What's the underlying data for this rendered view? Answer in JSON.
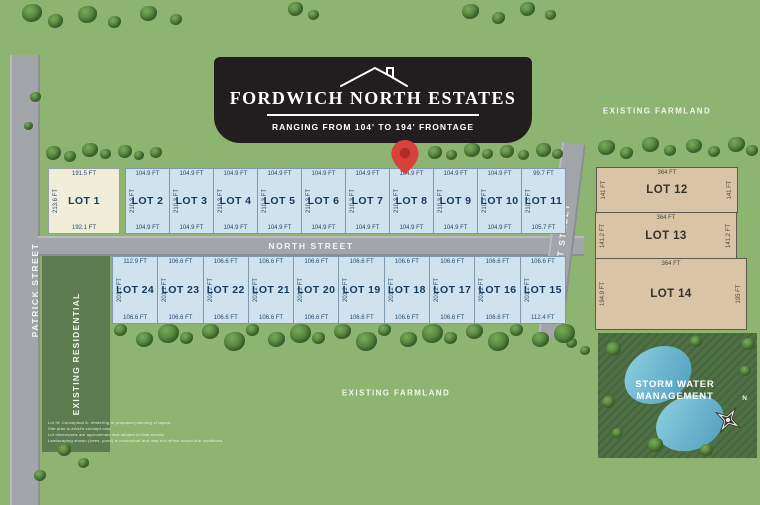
{
  "banner": {
    "title": "FORDWICH NORTH ESTATES",
    "subtitle": "RANGING FROM 104' TO 194' FRONTAGE"
  },
  "streets": {
    "patrick": "PATRICK STREET",
    "north": "NORTH STREET",
    "east": "EAST STREET"
  },
  "areas": {
    "farmland_top": "EXISTING FARMLAND",
    "farmland_bottom": "EXISTING FARMLAND",
    "residential": "EXISTING RESIDENTIAL",
    "storm_water_line1": "STORM WATER",
    "storm_water_line2": "MANAGEMENT"
  },
  "compass": {
    "north_label": "N"
  },
  "top_row": [
    {
      "name": "LOT 1",
      "top": "191.5 FT",
      "bottom": "192.1 FT",
      "side": "213.6 FT"
    },
    {
      "name": "LOT 2",
      "top": "104.9 FT",
      "bottom": "104.9 FT",
      "side": "210.3 FT"
    },
    {
      "name": "LOT 3",
      "top": "104.9 FT",
      "bottom": "104.9 FT",
      "side": "210.3 FT"
    },
    {
      "name": "LOT 4",
      "top": "104.9 FT",
      "bottom": "104.9 FT",
      "side": "210.3 FT"
    },
    {
      "name": "LOT 5",
      "top": "104.9 FT",
      "bottom": "104.9 FT",
      "side": "210.3 FT"
    },
    {
      "name": "LOT 6",
      "top": "104.9 FT",
      "bottom": "104.9 FT",
      "side": "210.3 FT"
    },
    {
      "name": "LOT 7",
      "top": "104.9 FT",
      "bottom": "104.9 FT",
      "side": "210.3 FT"
    },
    {
      "name": "LOT 8",
      "top": "104.9 FT",
      "bottom": "104.9 FT",
      "side": "210.3 FT"
    },
    {
      "name": "LOT 9",
      "top": "104.9 FT",
      "bottom": "104.9 FT",
      "side": "210.3 FT"
    },
    {
      "name": "LOT 10",
      "top": "104.9 FT",
      "bottom": "104.9 FT",
      "side": "210.3 FT"
    },
    {
      "name": "LOT 11",
      "top": "99.7 FT",
      "bottom": "105.7 FT",
      "side": "210.3 FT"
    }
  ],
  "bottom_row": [
    {
      "name": "LOT 24",
      "top": "112.9 FT",
      "bottom": "106.6 FT",
      "side": "201.1 FT"
    },
    {
      "name": "LOT 23",
      "top": "106.6 FT",
      "bottom": "106.6 FT",
      "side": "201.1 FT"
    },
    {
      "name": "LOT 22",
      "top": "106.6 FT",
      "bottom": "106.6 FT",
      "side": "201.2 FT"
    },
    {
      "name": "LOT 21",
      "top": "106.6 FT",
      "bottom": "106.6 FT",
      "side": "201.2 FT"
    },
    {
      "name": "LOT 20",
      "top": "106.6 FT",
      "bottom": "106.6 FT",
      "side": "201.2 FT"
    },
    {
      "name": "LOT 19",
      "top": "106.6 FT",
      "bottom": "106.6 FT",
      "side": "201.2 FT"
    },
    {
      "name": "LOT 18",
      "top": "106.6 FT",
      "bottom": "106.6 FT",
      "side": "201.2 FT"
    },
    {
      "name": "LOT 17",
      "top": "106.6 FT",
      "bottom": "106.6 FT",
      "side": "201.2 FT"
    },
    {
      "name": "LOT 16",
      "top": "106.6 FT",
      "bottom": "106.6 FT",
      "side": "201.2 FT"
    },
    {
      "name": "LOT 15",
      "top": "106.6 FT",
      "bottom": "112.4 FT",
      "side": "201.2 FT"
    }
  ],
  "right_lots": [
    {
      "name": "LOT 12",
      "top": "364 FT",
      "left": "141 FT",
      "right": "141 FT",
      "height": 46
    },
    {
      "name": "LOT 13",
      "top": "364 FT",
      "left": "141.2 FT",
      "right": "141.2 FT",
      "height": 47
    },
    {
      "name": "LOT 14",
      "top": "364 FT",
      "left": "194.9 FT",
      "right": "195 FT",
      "height": 72
    }
  ],
  "disclaimer": [
    "Lot fit: Conceptual A. rendering of proposed planning of layout",
    "Site plan is artist's concept only",
    "Lot dimensions are approximate and subject to final survey",
    "Landscaping shown (trees, pond) is conceptual and may not reflect actual site conditions"
  ],
  "colors": {
    "accent_red": "#d8403a",
    "lot_blue": "#d0e2ee",
    "lot_cream": "#f0edd8",
    "lot_tan": "#d9c4a6",
    "road_gray": "#a2a5a9",
    "banner_dark": "#221e1f",
    "pond_blue": "#6db6d2",
    "background_green": "#8db470"
  }
}
